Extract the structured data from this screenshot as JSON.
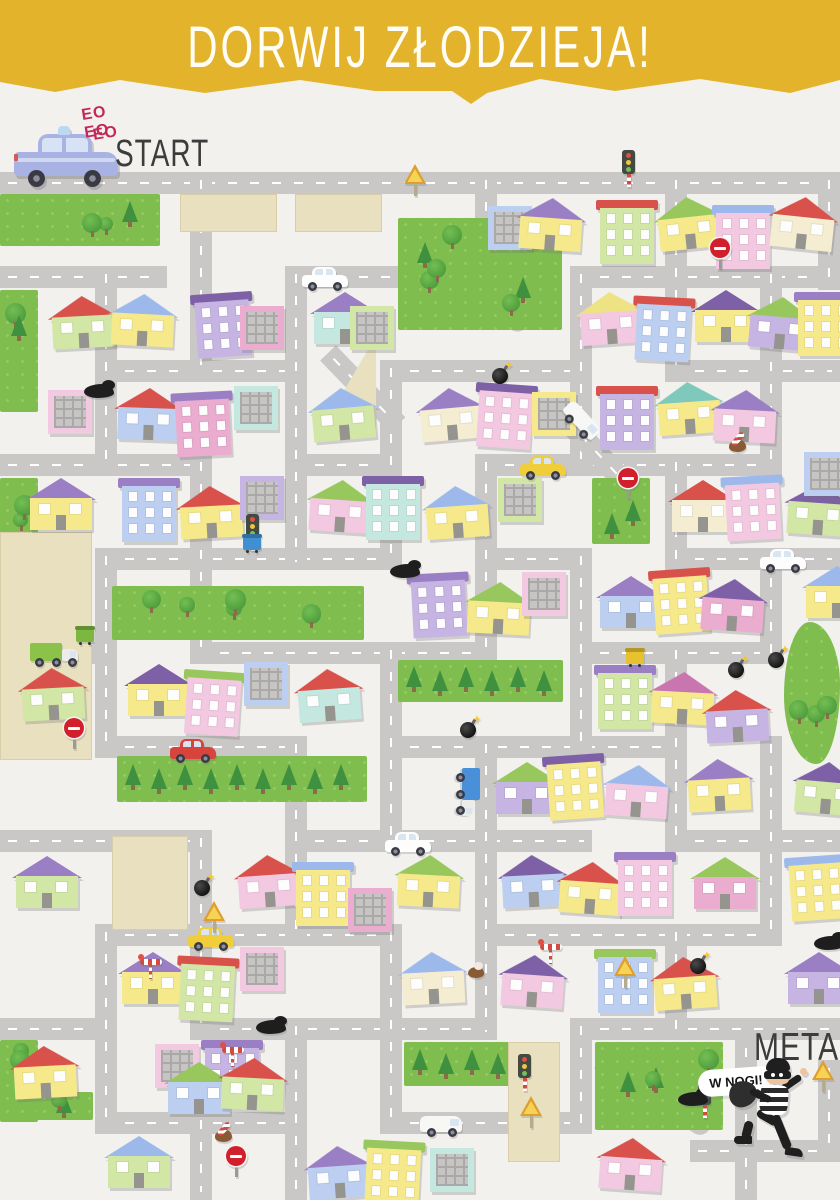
{
  "header": {
    "title": "DORWIJ ZŁODZIEJA!"
  },
  "start": {
    "sounds": [
      "EO EO",
      "EO"
    ],
    "label": "START",
    "vehicle": "police-car"
  },
  "finish": {
    "label": "META",
    "speech": "W NOGI!",
    "character": "thief"
  },
  "palette": {
    "banner": "#e3b32c",
    "background": "#f2f1ee",
    "road": "#c9c8c6",
    "road_dash": "#ffffff",
    "park": "#7fbd4f",
    "tree_round": "#4f9e3e",
    "tree_pine": "#3f9140",
    "plot_beige": "#e9e0bf",
    "ink": "#3c3c3c",
    "siren_text": "#c2285b",
    "bodies": {
      "y": "#f6e98c",
      "p": "#f2c9e0",
      "l": "#c6b4e2",
      "g": "#d2e7a6",
      "b": "#bccff1",
      "t": "#c4e8df",
      "m": "#eaaccf",
      "c": "#f4edd2"
    },
    "roofs": {
      "r": "#d8514b",
      "v": "#9b7fc5",
      "d": "#7e60a7",
      "g": "#98c75e",
      "b": "#9db9eb",
      "y": "#ede284",
      "t": "#7ec9bb",
      "m": "#c975af"
    }
  },
  "map": {
    "roads_h": [
      [
        172,
        0,
        840
      ],
      [
        266,
        0,
        167
      ],
      [
        266,
        285,
        113
      ],
      [
        266,
        570,
        270
      ],
      [
        360,
        95,
        212
      ],
      [
        360,
        380,
        212
      ],
      [
        360,
        665,
        175
      ],
      [
        454,
        0,
        212
      ],
      [
        454,
        285,
        117
      ],
      [
        454,
        475,
        307
      ],
      [
        548,
        95,
        307
      ],
      [
        548,
        475,
        117
      ],
      [
        548,
        665,
        175
      ],
      [
        642,
        0,
        117
      ],
      [
        642,
        190,
        307
      ],
      [
        642,
        570,
        212
      ],
      [
        736,
        95,
        212
      ],
      [
        736,
        380,
        307
      ],
      [
        830,
        0,
        212
      ],
      [
        830,
        285,
        307
      ],
      [
        830,
        665,
        175
      ],
      [
        924,
        95,
        307
      ],
      [
        924,
        475,
        307
      ],
      [
        1018,
        0,
        117
      ],
      [
        1018,
        190,
        307
      ],
      [
        1018,
        570,
        270
      ],
      [
        1112,
        95,
        212
      ],
      [
        1112,
        380,
        212
      ],
      [
        1140,
        690,
        150
      ]
    ],
    "roads_v": [
      [
        95,
        266,
        210
      ],
      [
        95,
        548,
        210
      ],
      [
        95,
        924,
        210
      ],
      [
        190,
        172,
        210
      ],
      [
        190,
        454,
        210
      ],
      [
        190,
        830,
        210
      ],
      [
        190,
        1112,
        88
      ],
      [
        285,
        266,
        304
      ],
      [
        285,
        736,
        210
      ],
      [
        285,
        1018,
        182
      ],
      [
        380,
        360,
        210
      ],
      [
        380,
        642,
        210
      ],
      [
        380,
        924,
        210
      ],
      [
        475,
        172,
        116
      ],
      [
        475,
        454,
        210
      ],
      [
        475,
        736,
        304
      ],
      [
        570,
        266,
        210
      ],
      [
        570,
        548,
        210
      ],
      [
        570,
        1018,
        116
      ],
      [
        665,
        172,
        210
      ],
      [
        665,
        454,
        116
      ],
      [
        665,
        642,
        210
      ],
      [
        665,
        924,
        116
      ],
      [
        760,
        266,
        210
      ],
      [
        760,
        548,
        116
      ],
      [
        760,
        736,
        210
      ],
      [
        735,
        1040,
        160
      ],
      [
        818,
        172,
        118
      ],
      [
        818,
        1060,
        102
      ]
    ],
    "roads_d": [
      [
        408,
        224,
        150,
        38,
        1
      ],
      [
        328,
        342,
        100,
        46,
        0
      ],
      [
        560,
        402,
        100,
        47,
        0
      ],
      [
        600,
        1048,
        130,
        33,
        1
      ]
    ],
    "parks": [
      [
        0,
        194,
        160,
        52,
        "m"
      ],
      [
        0,
        290,
        38,
        122,
        "m"
      ],
      [
        0,
        478,
        38,
        156,
        "m"
      ],
      [
        398,
        218,
        164,
        112,
        "m"
      ],
      [
        592,
        478,
        58,
        66,
        "m"
      ],
      [
        112,
        586,
        252,
        54,
        "m"
      ],
      [
        398,
        660,
        165,
        42,
        "r"
      ],
      [
        117,
        756,
        250,
        46,
        "r"
      ],
      [
        784,
        622,
        56,
        142,
        "b"
      ],
      [
        404,
        1042,
        130,
        44,
        "r"
      ],
      [
        595,
        1042,
        128,
        88,
        "m"
      ],
      [
        0,
        1040,
        38,
        82,
        "m"
      ],
      [
        37,
        1092,
        56,
        28,
        "m"
      ]
    ],
    "plots": [
      [
        180,
        194,
        95,
        36,
        "r"
      ],
      [
        295,
        194,
        85,
        36,
        "r"
      ],
      [
        322,
        336,
        54,
        92,
        "t"
      ],
      [
        0,
        532,
        90,
        226,
        "r"
      ],
      [
        112,
        836,
        74,
        92,
        "r"
      ],
      [
        508,
        1042,
        50,
        118,
        "r"
      ]
    ],
    "houses": [
      [
        488,
        206,
        "f",
        "b",
        "-",
        0
      ],
      [
        520,
        198,
        "h",
        "y",
        "v",
        4
      ],
      [
        600,
        200,
        "a",
        "g",
        "r",
        0
      ],
      [
        658,
        197,
        "h",
        "y",
        "g",
        -6
      ],
      [
        716,
        205,
        "a",
        "p",
        "b",
        0
      ],
      [
        772,
        197,
        "h",
        "c",
        "r",
        6
      ],
      [
        52,
        296,
        "h",
        "g",
        "r",
        -3
      ],
      [
        112,
        294,
        "h",
        "y",
        "b",
        3
      ],
      [
        196,
        293,
        "a",
        "l",
        "d",
        -4
      ],
      [
        240,
        306,
        "f",
        "m",
        "-",
        0
      ],
      [
        314,
        292,
        "h",
        "t",
        "v",
        0
      ],
      [
        350,
        306,
        "f",
        "g",
        "-",
        0
      ],
      [
        580,
        292,
        "h",
        "p",
        "y",
        -4
      ],
      [
        636,
        297,
        "a",
        "b",
        "r",
        3
      ],
      [
        695,
        290,
        "h",
        "y",
        "d",
        0
      ],
      [
        750,
        297,
        "h",
        "l",
        "g",
        5
      ],
      [
        798,
        292,
        "a",
        "y",
        "v",
        0
      ],
      [
        48,
        390,
        "f",
        "p",
        "-",
        0
      ],
      [
        118,
        388,
        "h",
        "b",
        "r",
        2
      ],
      [
        176,
        392,
        "a",
        "m",
        "v",
        -3
      ],
      [
        234,
        386,
        "f",
        "t",
        "-",
        0
      ],
      [
        312,
        388,
        "h",
        "g",
        "b",
        -5
      ],
      [
        420,
        388,
        "h",
        "c",
        "v",
        -5
      ],
      [
        478,
        384,
        "a",
        "p",
        "d",
        4
      ],
      [
        532,
        392,
        "f",
        "y",
        "-",
        0
      ],
      [
        600,
        386,
        "a",
        "l",
        "r",
        0
      ],
      [
        658,
        382,
        "h",
        "y",
        "t",
        -4
      ],
      [
        714,
        390,
        "h",
        "p",
        "v",
        3
      ],
      [
        30,
        478,
        "h",
        "y",
        "v",
        0
      ],
      [
        122,
        478,
        "a",
        "b",
        "v",
        0
      ],
      [
        180,
        486,
        "h",
        "y",
        "r",
        -3
      ],
      [
        240,
        476,
        "f",
        "l",
        "-",
        0
      ],
      [
        310,
        480,
        "h",
        "p",
        "g",
        4
      ],
      [
        366,
        476,
        "a",
        "t",
        "d",
        0
      ],
      [
        426,
        486,
        "h",
        "y",
        "b",
        -4
      ],
      [
        498,
        478,
        "f",
        "g",
        "-",
        0
      ],
      [
        672,
        480,
        "h",
        "c",
        "r",
        0
      ],
      [
        726,
        476,
        "a",
        "p",
        "b",
        -3
      ],
      [
        788,
        483,
        "h",
        "g",
        "d",
        4
      ],
      [
        804,
        452,
        "f",
        "b",
        "-",
        0
      ],
      [
        412,
        573,
        "a",
        "l",
        "v",
        -3
      ],
      [
        468,
        582,
        "h",
        "y",
        "g",
        3
      ],
      [
        522,
        572,
        "f",
        "p",
        "-",
        0
      ],
      [
        600,
        576,
        "h",
        "b",
        "v",
        0
      ],
      [
        654,
        569,
        "a",
        "y",
        "r",
        -4
      ],
      [
        702,
        579,
        "h",
        "m",
        "d",
        4
      ],
      [
        806,
        566,
        "h",
        "y",
        "b",
        0
      ],
      [
        22,
        668,
        "h",
        "g",
        "r",
        -3
      ],
      [
        128,
        664,
        "h",
        "y",
        "d",
        0
      ],
      [
        186,
        671,
        "a",
        "p",
        "g",
        4
      ],
      [
        244,
        662,
        "f",
        "b",
        "-",
        0
      ],
      [
        298,
        669,
        "h",
        "t",
        "r",
        -4
      ],
      [
        598,
        665,
        "a",
        "g",
        "v",
        0
      ],
      [
        652,
        672,
        "h",
        "y",
        "m",
        3
      ],
      [
        706,
        690,
        "h",
        "l",
        "r",
        -3
      ],
      [
        496,
        762,
        "h",
        "l",
        "g",
        0
      ],
      [
        548,
        755,
        "a",
        "y",
        "d",
        -4
      ],
      [
        606,
        765,
        "h",
        "p",
        "b",
        4
      ],
      [
        688,
        759,
        "h",
        "y",
        "v",
        -3
      ],
      [
        796,
        762,
        "h",
        "g",
        "d",
        5
      ],
      [
        16,
        856,
        "h",
        "g",
        "v",
        0
      ],
      [
        238,
        855,
        "h",
        "p",
        "r",
        -4
      ],
      [
        296,
        862,
        "a",
        "y",
        "b",
        0
      ],
      [
        348,
        888,
        "f",
        "m",
        "-",
        0
      ],
      [
        398,
        855,
        "h",
        "y",
        "g",
        3
      ],
      [
        502,
        855,
        "h",
        "b",
        "d",
        -3
      ],
      [
        560,
        862,
        "h",
        "y",
        "r",
        4
      ],
      [
        618,
        852,
        "a",
        "p",
        "v",
        0
      ],
      [
        694,
        857,
        "h",
        "m",
        "g",
        0
      ],
      [
        790,
        856,
        "a",
        "y",
        "b",
        -4
      ],
      [
        122,
        952,
        "h",
        "y",
        "v",
        0
      ],
      [
        180,
        957,
        "a",
        "g",
        "r",
        3
      ],
      [
        240,
        947,
        "f",
        "p",
        "-",
        0
      ],
      [
        402,
        952,
        "h",
        "c",
        "b",
        -3
      ],
      [
        502,
        955,
        "h",
        "p",
        "d",
        4
      ],
      [
        598,
        949,
        "a",
        "b",
        "g",
        0
      ],
      [
        654,
        957,
        "h",
        "y",
        "r",
        -4
      ],
      [
        788,
        952,
        "h",
        "l",
        "v",
        0
      ],
      [
        14,
        1046,
        "h",
        "y",
        "r",
        -3
      ],
      [
        155,
        1044,
        "f",
        "p",
        "-",
        0
      ],
      [
        205,
        1040,
        "a",
        "l",
        "v",
        0
      ],
      [
        168,
        1062,
        "h",
        "b",
        "g",
        0
      ],
      [
        222,
        1058,
        "h",
        "g",
        "r",
        3
      ],
      [
        108,
        1136,
        "h",
        "g",
        "b",
        0
      ],
      [
        308,
        1146,
        "h",
        "b",
        "v",
        -4
      ],
      [
        366,
        1141,
        "a",
        "y",
        "g",
        3
      ],
      [
        430,
        1148,
        "f",
        "t",
        "-",
        0
      ],
      [
        600,
        1138,
        "h",
        "p",
        "r",
        4
      ]
    ],
    "items": [
      {
        "t": "tlight",
        "x": 622,
        "y": 150
      },
      {
        "t": "yield",
        "x": 404,
        "y": 164
      },
      {
        "t": "noentry",
        "x": 710,
        "y": 238
      },
      {
        "t": "tlight",
        "x": 246,
        "y": 514
      },
      {
        "t": "noentry",
        "x": 64,
        "y": 718
      },
      {
        "t": "noentry",
        "x": 618,
        "y": 468
      },
      {
        "t": "bomb",
        "x": 492,
        "y": 364
      },
      {
        "t": "oil",
        "x": 84,
        "y": 384
      },
      {
        "t": "car",
        "x": 302,
        "y": 267,
        "c": "#fdfdfd"
      },
      {
        "t": "van",
        "x": 575,
        "y": 398,
        "r": 47
      },
      {
        "t": "car",
        "x": 520,
        "y": 456,
        "c": "#f0cd3a"
      },
      {
        "t": "bin",
        "x": 243,
        "y": 534,
        "c": "#3f8fd1"
      },
      {
        "t": "bin",
        "x": 76,
        "y": 626,
        "c": "#7cb83f"
      },
      {
        "t": "truck",
        "x": 30,
        "y": 643,
        "c": "#8bc34a"
      },
      {
        "t": "car",
        "x": 170,
        "y": 739,
        "c": "#d8443c"
      },
      {
        "t": "truck",
        "x": 480,
        "y": 768,
        "c": "#4a90d9",
        "r": 90
      },
      {
        "t": "car",
        "x": 385,
        "y": 832,
        "c": "#fdfdfd"
      },
      {
        "t": "bomb",
        "x": 460,
        "y": 718
      },
      {
        "t": "bomb",
        "x": 728,
        "y": 658
      },
      {
        "t": "oil",
        "x": 390,
        "y": 564
      },
      {
        "t": "candy",
        "x": 726,
        "y": 432
      },
      {
        "t": "splat",
        "x": 468,
        "y": 962
      },
      {
        "t": "car",
        "x": 188,
        "y": 927,
        "c": "#f0cd3a"
      },
      {
        "t": "crossing",
        "x": 140,
        "y": 956
      },
      {
        "t": "crossing",
        "x": 222,
        "y": 1044
      },
      {
        "t": "noentry",
        "x": 226,
        "y": 1146
      },
      {
        "t": "candy",
        "x": 212,
        "y": 1122
      },
      {
        "t": "bomb",
        "x": 194,
        "y": 876
      },
      {
        "t": "yield",
        "x": 203,
        "y": 901
      },
      {
        "t": "bomb",
        "x": 690,
        "y": 954
      },
      {
        "t": "yield",
        "x": 614,
        "y": 956
      },
      {
        "t": "oil",
        "x": 256,
        "y": 1020
      },
      {
        "t": "bin",
        "x": 626,
        "y": 648,
        "c": "#e8c22e"
      },
      {
        "t": "tlight",
        "x": 698,
        "y": 1081
      },
      {
        "t": "oil",
        "x": 678,
        "y": 1092
      },
      {
        "t": "yield",
        "x": 520,
        "y": 1096
      },
      {
        "t": "tlight",
        "x": 518,
        "y": 1054
      },
      {
        "t": "van",
        "x": 420,
        "y": 1114
      },
      {
        "t": "car",
        "x": 760,
        "y": 549,
        "c": "#fdfdfd"
      },
      {
        "t": "oil",
        "x": 814,
        "y": 936
      },
      {
        "t": "bomb",
        "x": 768,
        "y": 648
      },
      {
        "t": "yield",
        "x": 812,
        "y": 1060
      },
      {
        "t": "crossing",
        "x": 540,
        "y": 941
      }
    ]
  }
}
